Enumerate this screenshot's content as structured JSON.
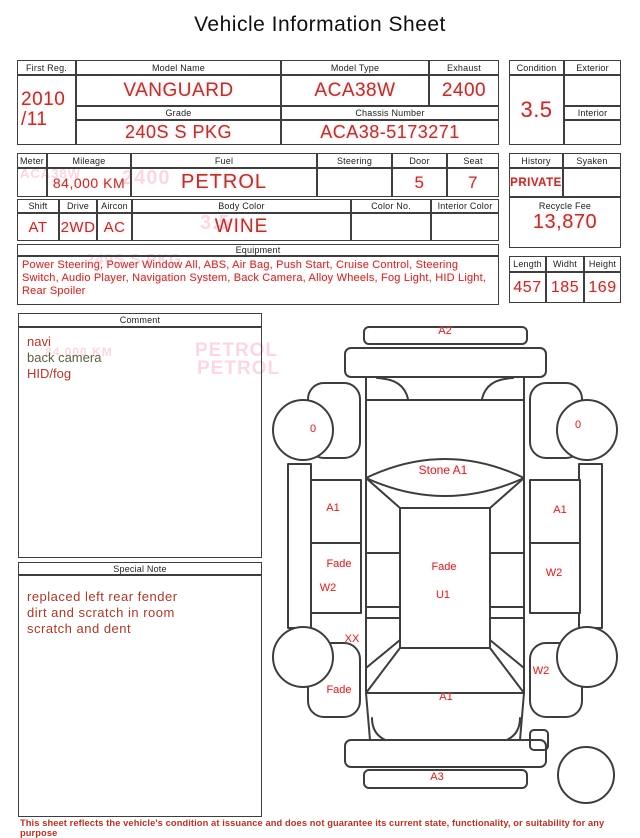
{
  "title": "Vehicle Information Sheet",
  "info": {
    "first_reg": {
      "label": "First Reg.",
      "value_line1": "2010",
      "value_line2": "/11"
    },
    "model_name": {
      "label": "Model Name",
      "value": "VANGUARD"
    },
    "model_type": {
      "label": "Model Type",
      "value": "ACA38W"
    },
    "exhaust": {
      "label": "Exhaust",
      "value": "2400"
    },
    "grade": {
      "label": "Grade",
      "value": "240S S PKG"
    },
    "chassis_number": {
      "label": "Chassis Number",
      "value": "ACA38-5173271"
    },
    "condition": {
      "label": "Condition",
      "value": "3.5"
    },
    "exterior": {
      "label": "Exterior",
      "value": ""
    },
    "interior": {
      "label": "Interior",
      "value": ""
    },
    "meter": {
      "label": "Meter",
      "value": ""
    },
    "mileage": {
      "label": "Mileage",
      "value": "84,000 KM"
    },
    "fuel": {
      "label": "Fuel",
      "value": "PETROL"
    },
    "steering": {
      "label": "Steering",
      "value": ""
    },
    "door": {
      "label": "Door",
      "value": "5"
    },
    "seat": {
      "label": "Seat",
      "value": "7"
    },
    "history": {
      "label": "History",
      "value": "PRIVATE"
    },
    "syaken": {
      "label": "Syaken",
      "value": ""
    },
    "recycle_fee": {
      "label": "Recycle Fee",
      "value": "13,870"
    },
    "shift": {
      "label": "Shift",
      "value": "AT"
    },
    "drive": {
      "label": "Drive",
      "value": "2WD"
    },
    "aircon": {
      "label": "Aircon",
      "value": "AC"
    },
    "body_color": {
      "label": "Body Color",
      "value": "WINE"
    },
    "color_no": {
      "label": "Color No.",
      "value": ""
    },
    "interior_color": {
      "label": "Interior Color",
      "value": ""
    },
    "equipment": {
      "label": "Equipment",
      "value": "Power Steering, Power Window  All, ABS, Air Bag, Push Start, Cruise Control, Steering Switch, Audio Player, Navigation System, Back Camera, Alloy Wheels, Fog Light, HID Light, Rear Spoiler"
    },
    "dimensions": {
      "length": {
        "label": "Length",
        "value": "457"
      },
      "width": {
        "label": "Widht",
        "value": "185"
      },
      "height": {
        "label": "Height",
        "value": "169"
      }
    }
  },
  "comment": {
    "label": "Comment",
    "lines": [
      {
        "text": "navi",
        "color": "#b03a2c"
      },
      {
        "text": "back camera",
        "color": "#5c5f3e"
      },
      {
        "text": "HID/fog",
        "color": "#b03a2c"
      }
    ]
  },
  "special_note": {
    "label": "Special Note",
    "lines": [
      "replaced left rear fender",
      "dirt and scratch in room",
      "scratch and dent"
    ]
  },
  "diagram": {
    "labels": [
      {
        "text": "A2",
        "x": 445,
        "y": 331
      },
      {
        "text": "0",
        "x": 313,
        "y": 429
      },
      {
        "text": "0",
        "x": 578,
        "y": 425
      },
      {
        "text": "Stone A1",
        "x": 443,
        "y": 471,
        "size": 12
      },
      {
        "text": "A1",
        "x": 333,
        "y": 508
      },
      {
        "text": "A1",
        "x": 560,
        "y": 510
      },
      {
        "text": "Fade",
        "x": 339,
        "y": 564
      },
      {
        "text": "W2",
        "x": 328,
        "y": 588
      },
      {
        "text": "Fade",
        "x": 444,
        "y": 567
      },
      {
        "text": "U1",
        "x": 443,
        "y": 595
      },
      {
        "text": "W2",
        "x": 554,
        "y": 573
      },
      {
        "text": "XX",
        "x": 352,
        "y": 639
      },
      {
        "text": "W2",
        "x": 541,
        "y": 671
      },
      {
        "text": "Fade",
        "x": 339,
        "y": 690
      },
      {
        "text": "A1",
        "x": 446,
        "y": 697
      },
      {
        "text": "A3",
        "x": 437,
        "y": 777
      }
    ]
  },
  "watermarks": [
    {
      "text": "ACA38W",
      "x": 20,
      "y": 166,
      "size": 13
    },
    {
      "text": "2400",
      "x": 122,
      "y": 167,
      "size": 20
    },
    {
      "text": "3.5",
      "x": 200,
      "y": 212,
      "size": 20
    },
    {
      "text": "240S S PKG",
      "x": 86,
      "y": 251,
      "size": 15
    },
    {
      "text": "84,000 KM",
      "x": 45,
      "y": 345,
      "size": 12
    },
    {
      "text": "PETROL",
      "x": 195,
      "y": 340,
      "size": 19
    },
    {
      "text": "PETROL",
      "x": 197,
      "y": 358,
      "size": 19
    }
  ],
  "footer": "This sheet reflects the vehicle's condition at issuance and does not guarantee its current state, functionality, or suitability for any purpose",
  "colors": {
    "value_red": "#a8392c",
    "label_black": "#1d1d1d",
    "line": "#3d3d3d",
    "ghost_pink": "#f7bed2",
    "comment_olive": "#5c5f3e"
  }
}
